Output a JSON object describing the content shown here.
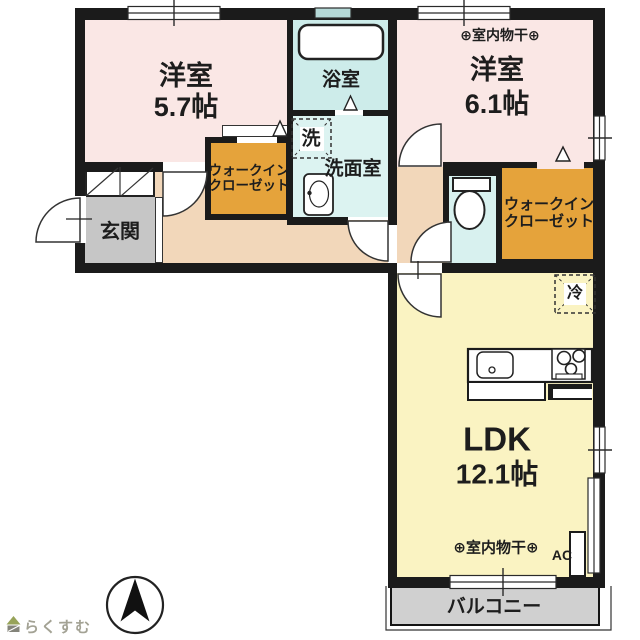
{
  "floorplan": {
    "rooms": {
      "bedroom1": {
        "name": "洋室",
        "size": "5.7帖"
      },
      "bedroom2": {
        "name": "洋室",
        "size": "6.1帖",
        "indoor_drying": "⊕室内物干⊕"
      },
      "bathroom": {
        "name": "浴室"
      },
      "washroom": {
        "name": "洗面室",
        "washer_mark": "洗"
      },
      "wic": {
        "line1": "ウォークイン",
        "line2": "クローゼット"
      },
      "entrance": {
        "name": "玄関"
      },
      "ldk": {
        "name": "LDK",
        "size": "12.1帖",
        "indoor_drying": "⊕室内物干⊕",
        "ac_label": "AC",
        "fridge_mark": "冷"
      },
      "balcony": {
        "name": "バルコニー"
      }
    },
    "branding": {
      "logo_text": "らくすむ"
    },
    "colors": {
      "wall": "#1b1b1b",
      "bedroom": "#fae7e5",
      "bathroom": "#cdecea",
      "washroom": "#dcf3f1",
      "closet": "#e5a33b",
      "corridor": "#f2d7ba",
      "entrance_floor": "#c6c6c6",
      "ldk": "#faf3c2",
      "balcony": "#d0d0d0"
    }
  }
}
